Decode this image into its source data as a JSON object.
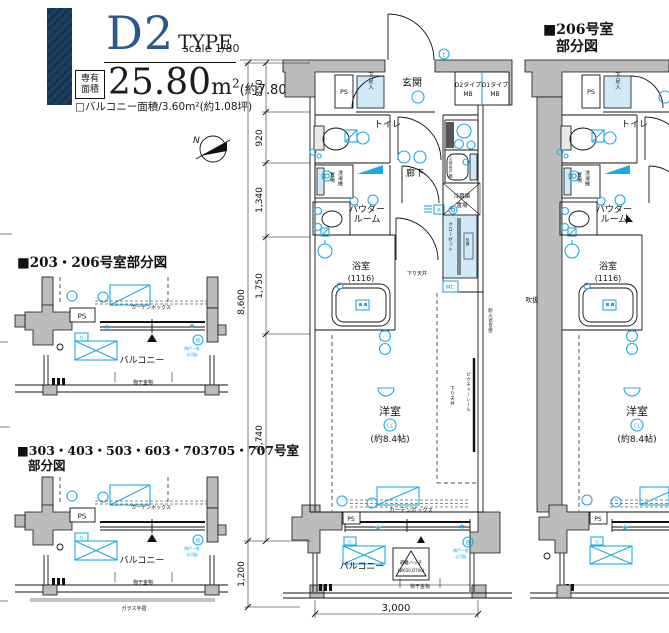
{
  "header": {
    "type_code": "D2",
    "type_word": "TYPE",
    "scale": "scale 1/80",
    "area_box": [
      "専有",
      "面積"
    ],
    "area_value": "25.80",
    "area_unit": "m",
    "area_unit_sup": "2",
    "area_tsubo": "(約7.80坪)",
    "balcony_line": "□バルコニー面積/3.60m²(約1.08坪)"
  },
  "compass": {
    "north": "N"
  },
  "dims": {
    "d850": "850",
    "d920": "920",
    "d1340": "1,340",
    "d1750": "1,750",
    "d3740": "3,740",
    "d8600": "8,600",
    "d1200": "1,200",
    "d3000": "3,000"
  },
  "labels": {
    "genkan": "玄関",
    "ps": "PS",
    "shoe_box": "下足入",
    "mb_d2": "D2タイプ",
    "mb_d1": "D1タイプ",
    "mb": "MB",
    "toilet": "トイレ",
    "hallway": "廊下",
    "washer_line1": "洗濯機",
    "washer_line2": "置場",
    "powder_line1": "パウダー",
    "powder_line2": "ルーム",
    "bath": "浴室",
    "bath_size": "(1116)",
    "fridge_line1": "冷蔵庫",
    "fridge_line2": "置場",
    "upper_cabinet": "上部吊戸棚",
    "closet": "クローゼット",
    "shelf": "枕棚",
    "mc": "MC",
    "r_box": "R",
    "t_mark": "t",
    "g_mark": "G",
    "b_mark": "B",
    "cl_mark": "CL",
    "down_ceiling": "下り天井",
    "western_room": "洋室",
    "western_room_size": "(約8.4帖)",
    "picture_rail": "ピクチャーレール",
    "fireproof_wall": "耐火遮音壁",
    "void": "吹抜",
    "curtain_box": "カーテンボックス",
    "balcony": "バルコニー",
    "hatch_line1": "避難ハッチ",
    "hatch_line2": "(W650,D700)",
    "laundry_hook": "物干金物",
    "glass_rail": "ガラス手摺",
    "partition_line1": "隣戸ー境",
    "partition_line2": "仕切板"
  },
  "sections": {
    "right_title_line1": "■206号室",
    "right_title_line2": "部分図",
    "mid_title": "■203・206号室部分図",
    "bottom_title_line1": "■303・403・503・603・703705・707号室",
    "bottom_title_line2": "部分図"
  },
  "colors": {
    "accent_cyan": "#1fa9e2",
    "wall_grey": "#bcbcbc",
    "header_navy": "#2a5a8c",
    "bar_navy": "#16334f",
    "light_blue_fill": "#cfe9f8"
  }
}
